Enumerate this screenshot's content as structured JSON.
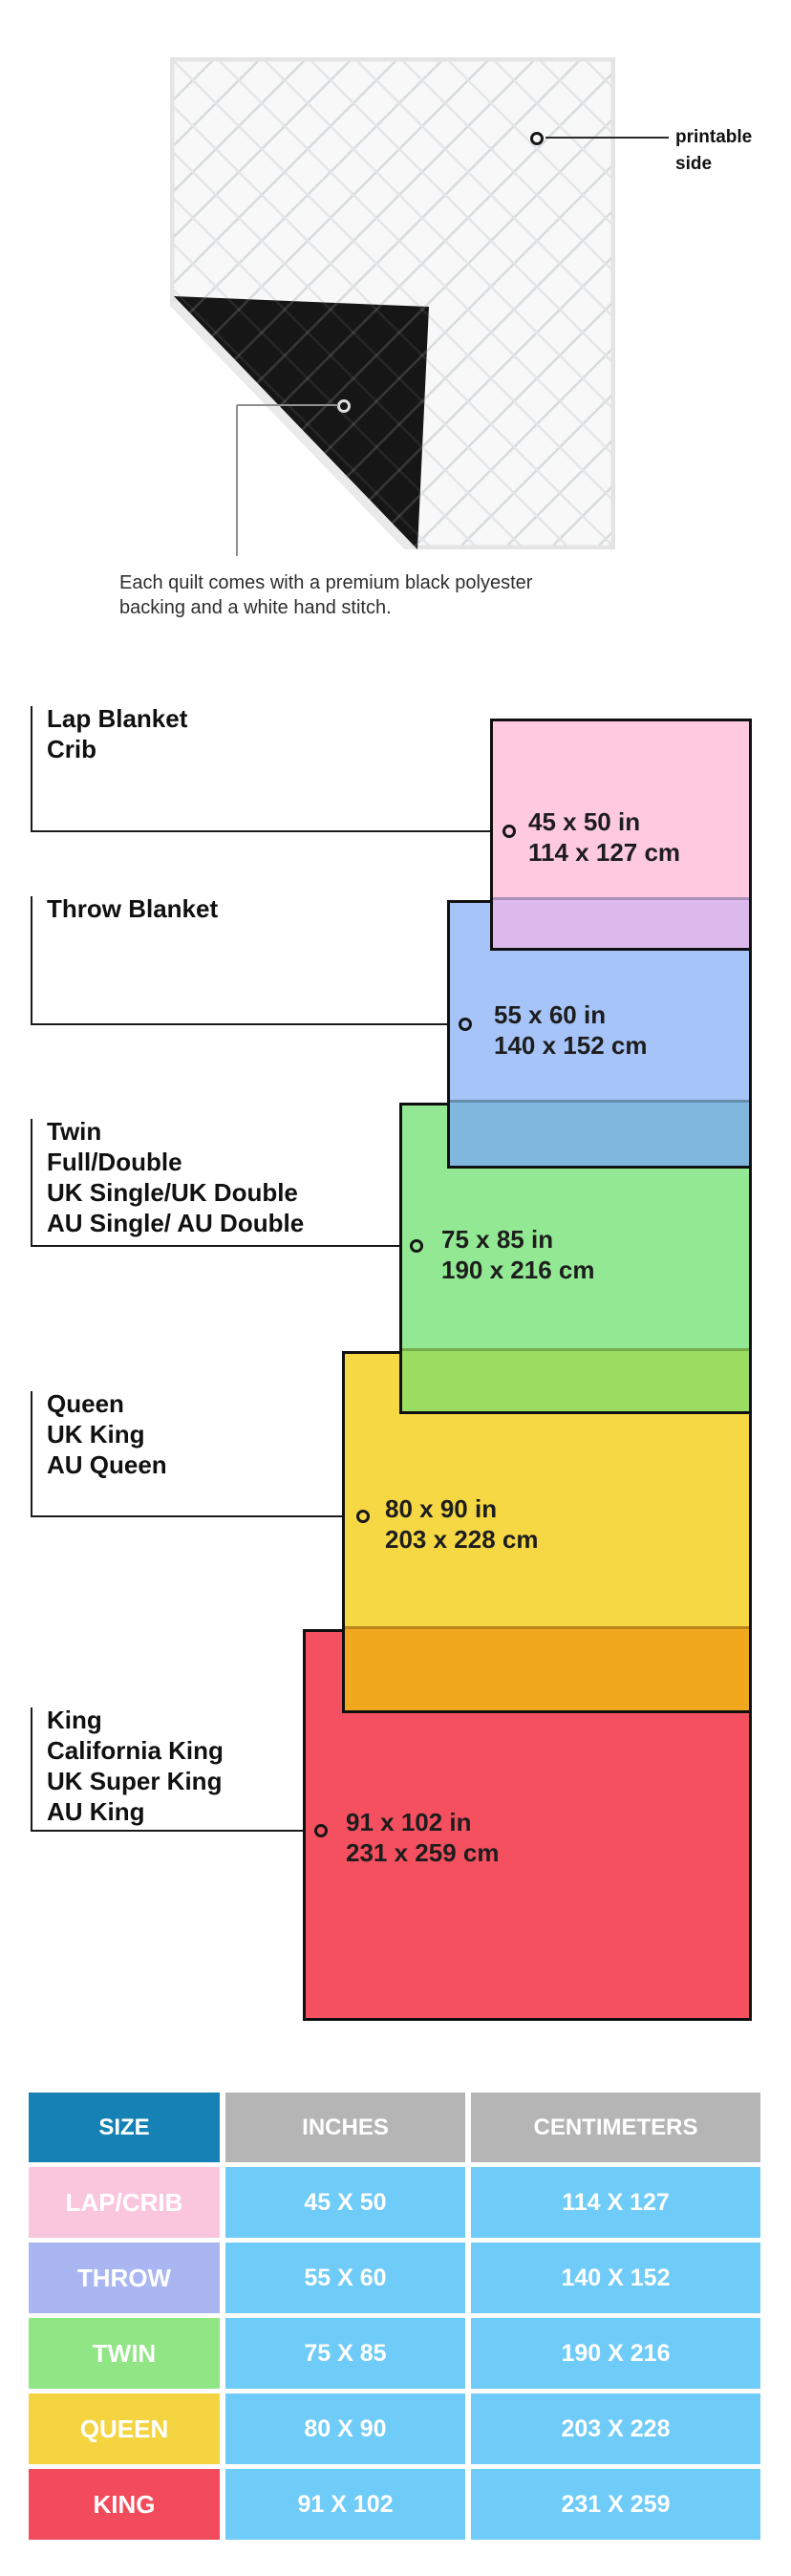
{
  "quilt": {
    "printable_side_label": "printable side",
    "caption": "Each quilt comes with a premium black polyester backing and a white hand stitch."
  },
  "diagram": {
    "items": [
      {
        "names": [
          "Lap Blanket",
          "Crib"
        ],
        "inches": "45 x 50 in",
        "cm": "114 x 127 cm"
      },
      {
        "names": [
          "Throw Blanket"
        ],
        "inches": "55 x 60 in",
        "cm": "140 x 152 cm"
      },
      {
        "names": [
          "Twin",
          "Full/Double",
          "UK Single/UK Double",
          "AU Single/ AU Double"
        ],
        "inches": "75 x 85 in",
        "cm": "190 x 216 cm"
      },
      {
        "names": [
          "Queen",
          "UK King",
          "AU Queen"
        ],
        "inches": "80 x 90 in",
        "cm": "203 x 228 cm"
      },
      {
        "names": [
          "King",
          "California King",
          "UK Super King",
          "AU King"
        ],
        "inches": "91 x 102 in",
        "cm": "231 x 259 cm"
      }
    ]
  },
  "table": {
    "headers": [
      "SIZE",
      "INCHES",
      "CENTIMETERS"
    ],
    "rows": [
      {
        "size": "LAP/CRIB",
        "inches": "45 X 50",
        "cm": "114 X 127"
      },
      {
        "size": "THROW",
        "inches": "55 X 60",
        "cm": "140 X 152"
      },
      {
        "size": "TWIN",
        "inches": "75 X 85",
        "cm": "190 X 216"
      },
      {
        "size": "QUEEN",
        "inches": "80 X 90",
        "cm": "203 X 228"
      },
      {
        "size": "KING",
        "inches": "91 X 102",
        "cm": "231 X 259"
      }
    ]
  },
  "colors": {
    "lap_pink": "#ffc9e0",
    "lap_pink_overlap": "#dcb9ec",
    "throw_blue": "#a6c4f8",
    "throw_blue_overlap": "#7fb7de",
    "twin_green": "#93e993",
    "twin_green_overlap": "#9add60",
    "queen_yellow": "#f6d845",
    "queen_yellow_overlap": "#f1a81f",
    "king_red": "#f4505f",
    "table_header_blue": "#1581b5",
    "table_header_gray": "#b5b5b5",
    "table_value_blue": "#6fcbf7",
    "row_pink": "#fac6de",
    "row_periwinkle": "#a9b6f2",
    "row_green": "#90e585",
    "row_yellow": "#f4d441",
    "row_red": "#f24b5c"
  },
  "chart_data": {
    "type": "table",
    "title": "Quilt blanket size comparison",
    "categories": [
      "Lap/Crib",
      "Throw",
      "Twin",
      "Queen",
      "King"
    ],
    "series": [
      {
        "name": "inches (width x length)",
        "values": [
          [
            45,
            50
          ],
          [
            55,
            60
          ],
          [
            75,
            85
          ],
          [
            80,
            90
          ],
          [
            91,
            102
          ]
        ]
      },
      {
        "name": "centimeters (width x length)",
        "values": [
          [
            114,
            127
          ],
          [
            140,
            152
          ],
          [
            190,
            216
          ],
          [
            203,
            228
          ],
          [
            231,
            259
          ]
        ]
      }
    ],
    "legend_position": "none",
    "grid": false
  }
}
